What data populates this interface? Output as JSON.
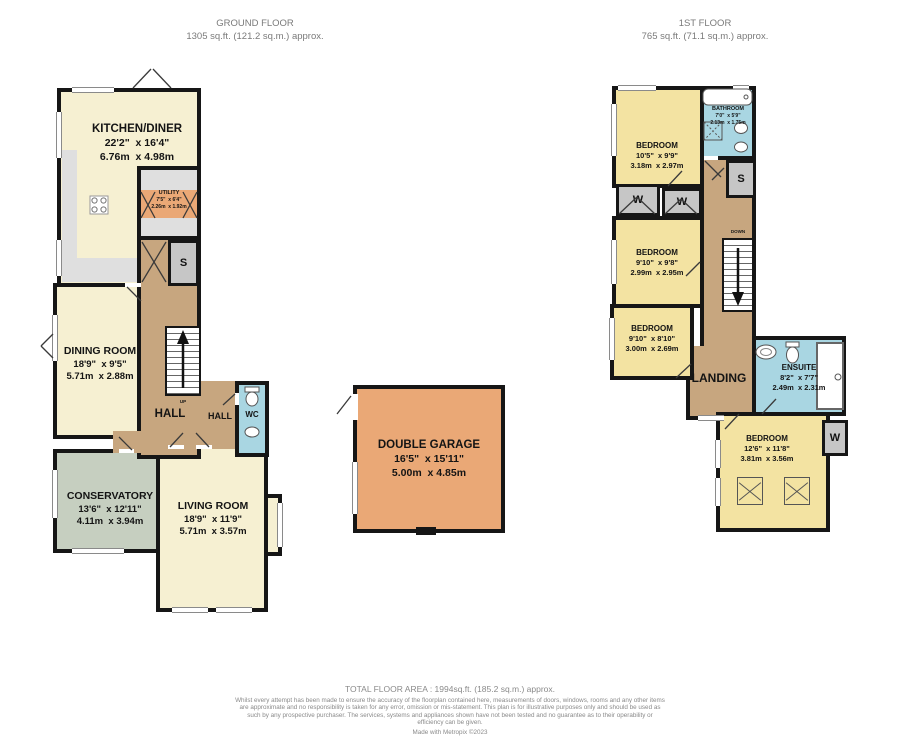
{
  "header": {
    "ground_title": "GROUND FLOOR",
    "ground_subtitle": "1305 sq.ft. (121.2 sq.m.) approx.",
    "first_title": "1ST FLOOR",
    "first_subtitle": "765 sq.ft. (71.1 sq.m.) approx."
  },
  "ground": {
    "kitchen": {
      "name": "KITCHEN/DINER",
      "imperial": "22'2\"  x 16'4\"",
      "metric": "6.76m  x 4.98m"
    },
    "utility": {
      "name": "UTILITY",
      "imperial": "7'5\"  x 6'4\"",
      "metric": "2.26m  x 1.92m"
    },
    "dining": {
      "name": "DINING ROOM",
      "imperial": "18'9\"  x 9'5\"",
      "metric": "5.71m  x 2.88m"
    },
    "conservatory": {
      "name": "CONSERVATORY",
      "imperial": "13'6\"  x 12'11\"",
      "metric": "4.11m  x 3.94m"
    },
    "living": {
      "name": "LIVING ROOM",
      "imperial": "18'9\"  x 11'9\"",
      "metric": "5.71m  x 3.57m"
    },
    "garage": {
      "name": "DOUBLE GARAGE",
      "imperial": "16'5\"  x 15'11\"",
      "metric": "5.00m  x 4.85m"
    },
    "hall": {
      "label": "HALL"
    },
    "hall2": {
      "label": "HALL"
    },
    "wc": {
      "label": "WC"
    },
    "up": {
      "label": "UP"
    },
    "store": {
      "label": "S"
    }
  },
  "first": {
    "bedroom1": {
      "name": "BEDROOM",
      "imperial": "10'5\"  x 9'9\"",
      "metric": "3.18m  x 2.97m"
    },
    "bathroom": {
      "name": "BATHROOM",
      "imperial": "7'0\"  x 5'9\"",
      "metric": "2.13m  x 1.75m"
    },
    "bedroom2": {
      "name": "BEDROOM",
      "imperial": "9'10\"  x 9'8\"",
      "metric": "2.99m  x 2.95m"
    },
    "bedroom3": {
      "name": "BEDROOM",
      "imperial": "9'10\"  x 8'10\"",
      "metric": "3.00m  x 2.69m"
    },
    "ensuite": {
      "name": "ENSUITE",
      "imperial": "8'2\"  x 7'7\"",
      "metric": "2.49m  x 2.31m"
    },
    "bedroom4": {
      "name": "BEDROOM",
      "imperial": "12'6\"  x 11'8\"",
      "metric": "3.81m  x 3.56m"
    },
    "landing": {
      "label": "LANDING"
    },
    "down": {
      "label": "DOWN"
    },
    "store": {
      "label": "S"
    },
    "wardrobe1": {
      "label": "W"
    },
    "wardrobe2": {
      "label": "W"
    },
    "wardrobe3": {
      "label": "W"
    }
  },
  "footer": {
    "total": "TOTAL FLOOR AREA : 1994sq.ft. (185.2 sq.m.) approx.",
    "disclaimer": "Whilst every attempt has been made to ensure the accuracy of the floorplan contained here, measurements of doors, windows, rooms and any other items are approximate and no responsibility is taken for any error, omission or mis-statement. This plan is for illustrative purposes only and should be used as such by any prospective purchaser. The services, systems and appliances shown have not been tested and no guarantee as to their operability or efficiency can be given.",
    "credit": "Made with Metropix ©2023"
  },
  "colors": {
    "wall": "#161616",
    "cream": "#f6f0d2",
    "bedroom_yellow": "#f3e3a2",
    "utility_orange": "#eaa876",
    "hall_brown": "#c7a67f",
    "bath_blue": "#a9d6e2",
    "conservatory_green": "#c6cfc0",
    "storage_gray": "#c6c6c6",
    "counter_gray": "#dfdfdf"
  }
}
